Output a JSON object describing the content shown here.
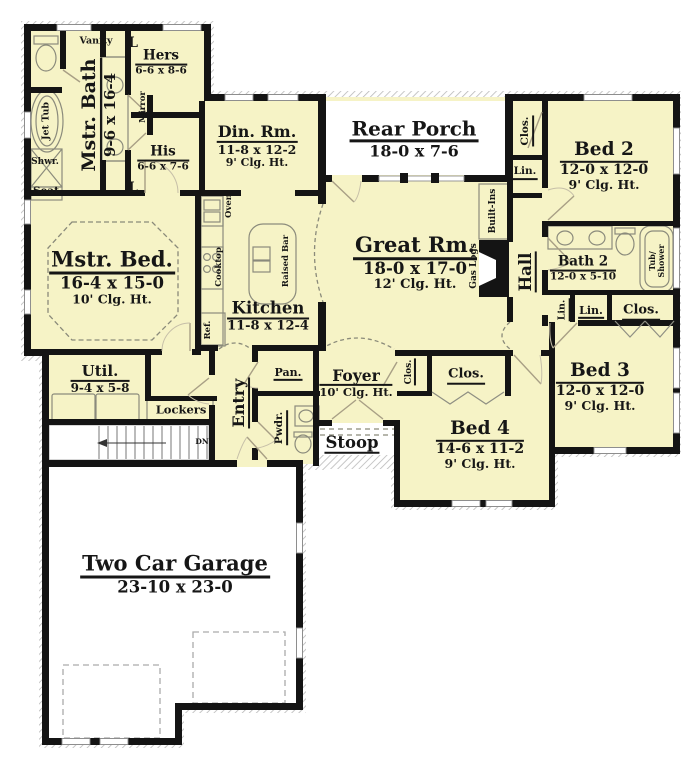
{
  "colors": {
    "floor": "#f6f3c6",
    "wall": "#141414",
    "outside": "#ffffff",
    "hatch": "#b9b9b9",
    "fixture_line": "#8b8b7c",
    "door_line": "#a89f85",
    "text": "#161616"
  },
  "rooms": {
    "mstr_bath": {
      "name": "Mstr. Bath",
      "dims": "9-6 x 16-4"
    },
    "hers": {
      "name": "Hers",
      "dims": "6-6 x 8-6"
    },
    "his": {
      "name": "His",
      "dims": "6-6 x 7-6"
    },
    "din": {
      "name": "Din. Rm.",
      "dims": "11-8 x 12-2",
      "clg": "9' Clg. Ht."
    },
    "rear_porch": {
      "name": "Rear Porch",
      "dims": "18-0 x 7-6"
    },
    "bed2": {
      "name": "Bed 2",
      "dims": "12-0 x 12-0",
      "clg": "9' Clg. Ht."
    },
    "mstr_bed": {
      "name": "Mstr. Bed.",
      "dims": "16-4 x 15-0",
      "clg": "10' Clg. Ht."
    },
    "kitchen": {
      "name": "Kitchen",
      "dims": "11-8 x 12-4"
    },
    "great": {
      "name": "Great Rm.",
      "dims": "18-0 x 17-0",
      "clg": "12' Clg. Ht."
    },
    "hall": {
      "name": "Hall"
    },
    "bath2": {
      "name": "Bath 2",
      "dims": "12-0 x 5-10"
    },
    "bed3": {
      "name": "Bed 3",
      "dims": "12-0 x 12-0",
      "clg": "9' Clg. Ht."
    },
    "util": {
      "name": "Util.",
      "dims": "9-4 x 5-8"
    },
    "entry": {
      "name": "Entry"
    },
    "pan": {
      "name": "Pan."
    },
    "pwdr": {
      "name": "Pwdr."
    },
    "foyer": {
      "name": "Foyer",
      "clg": "10' Clg. Ht."
    },
    "stoop": {
      "name": "Stoop"
    },
    "bed4": {
      "name": "Bed 4",
      "dims": "14-6 x 11-2",
      "clg": "9' Clg. Ht."
    },
    "garage": {
      "name": "Two Car Garage",
      "dims": "23-10 x 23-0"
    }
  },
  "closets": {
    "clos": "Clos.",
    "lin": "Lin.",
    "l": "L"
  },
  "fixtures": {
    "vanity": "Vanity",
    "mirror": "Mirror",
    "jet_tub": "Jet Tub",
    "shwr": "Shwr.",
    "seat": "Seat",
    "oven": "Oven",
    "cooktop": "Cooktop",
    "raised_bar": "Raised Bar",
    "ref": "Ref.",
    "built_ins": "Built-Ins",
    "gas_logs": "Gas Logs",
    "tub": "Tub/",
    "shower": "Shower",
    "lockers": "Lockers",
    "dn": "DN"
  }
}
